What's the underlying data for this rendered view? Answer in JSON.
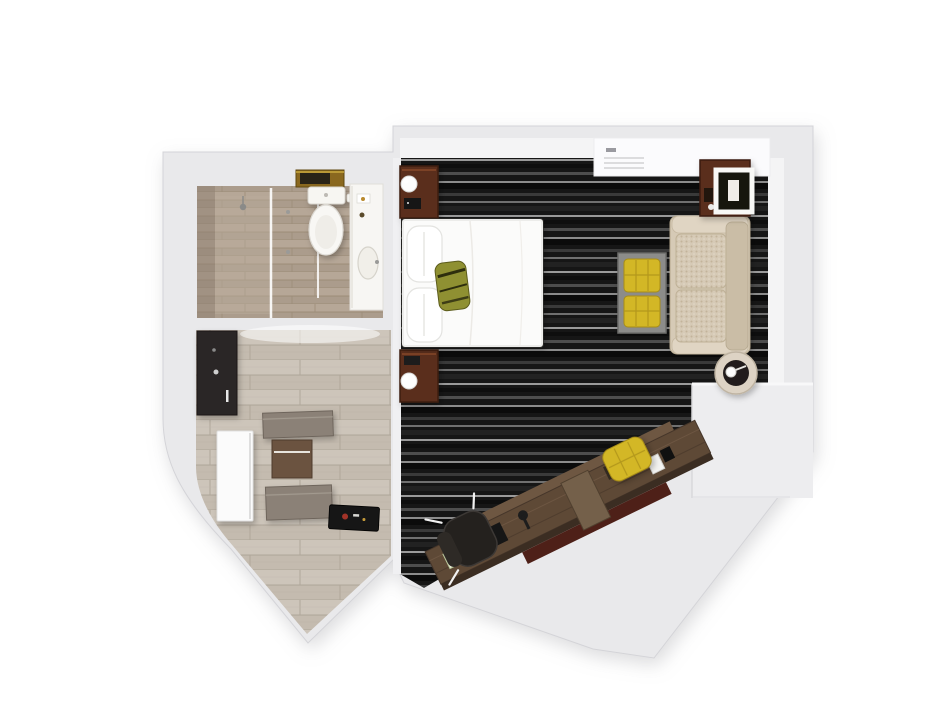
{
  "title": "3D top-down floor plan render of a hotel guest room",
  "background": "#ffffff",
  "palette": {
    "wall": "#e9e9eb",
    "wall_face": "#f4f4f5",
    "wall_edge": "#d4d4d8",
    "carpet_base": "#161616",
    "wood": "#cdc5ba",
    "tile": "#b4a596",
    "bed": "#fbfbfa",
    "pillow": "#ffffff",
    "olive": "#8f9030",
    "sofa": "#d6cab6",
    "sofa_back": "#cabda6",
    "mahogany": "#5a2d1c",
    "desk": "#5e4936",
    "desk_edge": "#3b2d22",
    "yellow": "#d3b727",
    "bench_gray": "#8c8c8a",
    "door": "#fbfbfb",
    "mat": "#161616",
    "cabinet": "#2c2825",
    "shelf": "#8b8177",
    "gold": "#8a681f",
    "maroon": "#4e2018",
    "ceiling_panel": "#fbfbfd",
    "lamp_white": "#fdfdfd",
    "toilet_white": "#f7f6f2"
  },
  "rooms": [
    {
      "name": "bathroom",
      "items": [
        "walk-in shower with glass partitions",
        "toilet with gold wall shelf and dark towels",
        "white vanity counter with oval sink"
      ]
    },
    {
      "name": "entry-closet",
      "items": [
        "dark minibar cabinet",
        "upper wall shelf",
        "luggage box",
        "lower wall shelf",
        "open white door leaf",
        "black floor mat with print"
      ]
    },
    {
      "name": "bedroom-living",
      "items": [
        "double bed with white duvet, two pillows and olive striped throw pillow",
        "two mahogany nightstands with white globe lamps and clock",
        "ceiling panel with vent",
        "beige two-seat sofa against right wall",
        "mahogany side table with white square-frame lamp",
        "gray bench coffee table with two yellow tufted cushions",
        "round side table with ring lamp",
        "long diagonal walnut desk with office chair, desk lamp, phone and tray",
        "yellow tufted stool"
      ]
    }
  ]
}
